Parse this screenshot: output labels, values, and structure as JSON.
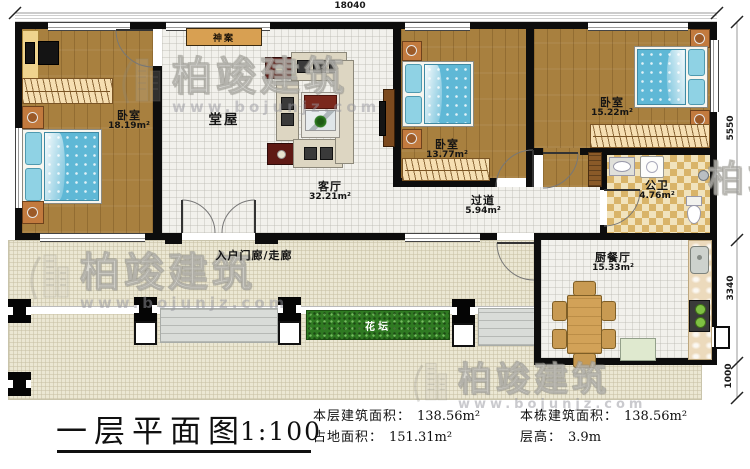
{
  "plan": {
    "dim_top": "18040",
    "dim_right_main": "5550",
    "dim_right_kitchen": "3340",
    "dim_right_terrace": "1000",
    "rooms": {
      "bedroom1": {
        "label": "卧室",
        "area": "18.19m²"
      },
      "hall": {
        "label": "堂屋"
      },
      "living": {
        "label": "客厅",
        "area": "32.21m²"
      },
      "bedroom2": {
        "label": "卧室",
        "area": "13.77m²"
      },
      "bedroom3": {
        "label": "卧室",
        "area": "15.22m²"
      },
      "corridor": {
        "label": "过道",
        "area": "5.94m²"
      },
      "bathroom": {
        "label": "公卫",
        "area": "4.76m²"
      },
      "kitchen": {
        "label": "厨餐厅",
        "area": "15.33m²"
      },
      "porch": {
        "label": "入户门廊/走廊"
      },
      "flowerbed": {
        "label": "花坛"
      },
      "altar": {
        "label": "神案"
      }
    }
  },
  "watermark": {
    "brand": "柏竣建筑",
    "url": "www.bojunjz.com"
  },
  "titleblock": {
    "title": "一层平面图",
    "scale": "1:100",
    "stats": [
      {
        "label": "本层建筑面积：",
        "value": "138.56m²"
      },
      {
        "label": "占地面积：",
        "value": "151.31m²"
      },
      {
        "label": "本栋建筑面积：",
        "value": "138.56m²"
      },
      {
        "label": "层高：",
        "value": "3.9m"
      }
    ]
  }
}
